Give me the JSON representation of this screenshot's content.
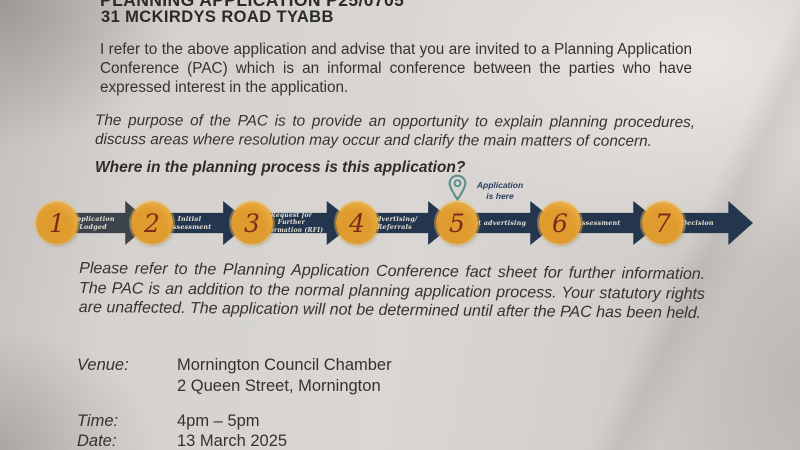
{
  "letter": {
    "ref_line": "PLANNING APPLICATION P25/0705",
    "address_line": "31 MCKIRDYS ROAD TYABB",
    "para1": "I refer to the above application and advise that you are invited to a Planning Application Conference (PAC) which is an informal conference between the parties who have expressed interest in the application.",
    "para2": "The purpose of the PAC is to provide an opportunity to explain planning procedures, discuss areas where resolution may occur and clarify the main matters of concern.",
    "process_heading": "Where in the planning process is this application?",
    "para3": "Please refer to the Planning Application Conference fact sheet for further information. The PAC is an addition to the normal planning application process. Your statutory rights are unaffected. The application will not be determined until after the PAC has been held.",
    "details": {
      "venue": {
        "label": "Venue:",
        "line1": "Mornington Council Chamber",
        "line2": "2 Queen Street, Mornington"
      },
      "time": {
        "label": "Time:",
        "value": "4pm – 5pm"
      },
      "date": {
        "label": "Date:",
        "value": "13 March 2025"
      }
    }
  },
  "process": {
    "marker_label": "Application is here",
    "marker_icon": "location-pin-icon",
    "steps": [
      {
        "number": "1",
        "label": "Application Lodged"
      },
      {
        "number": "2",
        "label": "Initial Assessment"
      },
      {
        "number": "3",
        "label": "Request for Further Information (RFI)"
      },
      {
        "number": "4",
        "label": "Advertising/ Referrals"
      },
      {
        "number": "5",
        "label": "Post advertising"
      },
      {
        "number": "6",
        "label": "Assessment"
      },
      {
        "number": "7",
        "label": "Decision"
      }
    ]
  },
  "colors": {
    "paper": "#d6d3d0",
    "arrow_navy": "#24364e",
    "arrow_first": "#3c434b",
    "circle_orange": "#e7a63c",
    "number_maroon": "#7c2a1c",
    "pin_teal": "#5a8f8a",
    "text": "#33312e"
  }
}
